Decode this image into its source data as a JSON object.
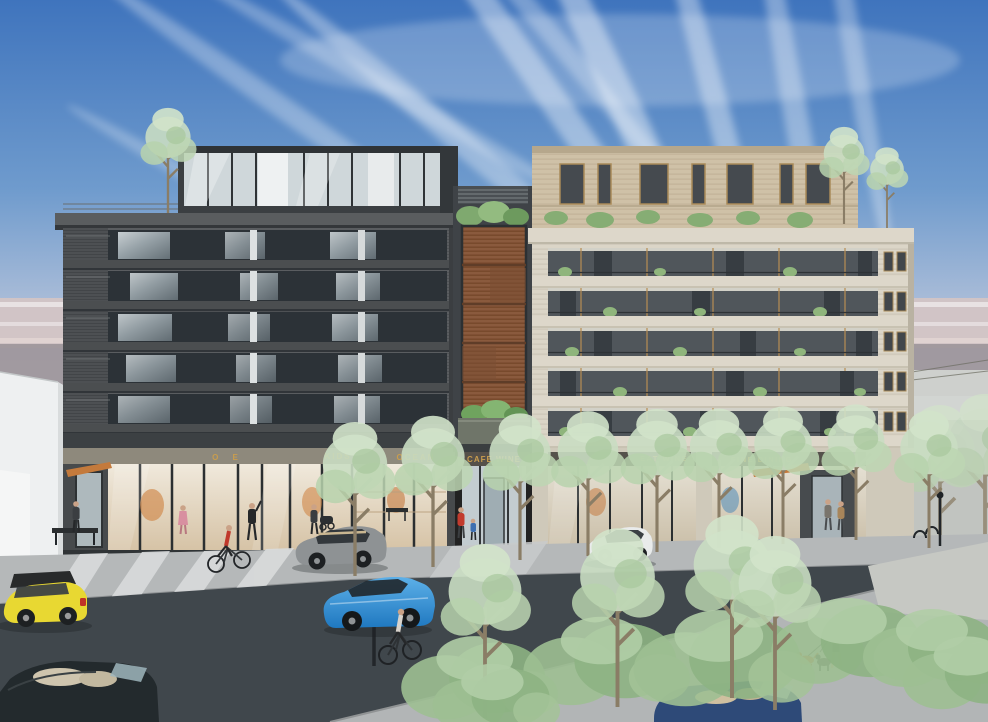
{
  "meta": {
    "type": "architectural street rendering",
    "subject": "Mixed-use apartment block: dark charcoal building (left) and cream stone building (right) joined by a wood-louver connector, ground-floor retail, tree-lined street with cars, cyclists and pedestrians"
  },
  "signs": {
    "color": "#c99d4e",
    "left_a": "O E",
    "left_b": "KIDS",
    "left_c": "OCEAN",
    "center": "CAFE WINE",
    "right_a": "EAT WINE",
    "right_b": "FINE DINING"
  },
  "colors": {
    "sky_top": "#3f74bd",
    "sky_pale": "#cfcdd6",
    "haze_pink": "#d7c5c3",
    "haze_gray": "#9d959a",
    "cloud": "#ffffff",
    "left_facade": "#55585a",
    "window_dark": "#2e3439",
    "right_facade": "#dbd5c7",
    "right_penthouse": "#cfc1a7",
    "wood_louver": "#8a5a3d",
    "balcony_trim": "#b98d52",
    "tree_foliage": "#c9ddc2",
    "road": "#40474c",
    "sidewalk": "#b5b8b9",
    "canopy_orange": "#c47a3c"
  },
  "objects": {
    "vehicles": [
      {
        "name": "yellow-mini",
        "color": "#e8d832"
      },
      {
        "name": "blue-sedan",
        "color": "#2f8fd8"
      },
      {
        "name": "silver-hatchback",
        "color": "#8e9294"
      },
      {
        "name": "white-sedan",
        "color": "#e9ebeb"
      },
      {
        "name": "dark-convertible",
        "color": "#232a2d"
      },
      {
        "name": "navy-convertible",
        "color": "#2e4a78"
      }
    ],
    "people": [
      "person-at-bench",
      "woman-pink",
      "cyclist-red",
      "man-waving",
      "woman-stroller",
      "mother-and-child",
      "cyclist-road",
      "couple-at-entrance",
      "dog-walker"
    ],
    "animals": [
      "orange-dog",
      "black-dog"
    ]
  }
}
